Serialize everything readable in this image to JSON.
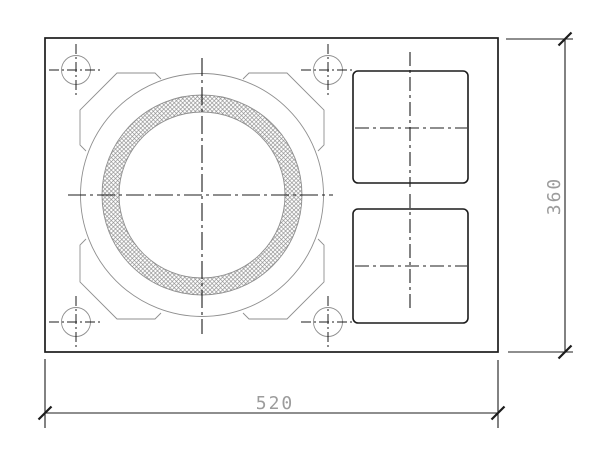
{
  "drawing": {
    "background": "#ffffff",
    "colors": {
      "primary_line": "#1c1c1c",
      "thin_line": "#8f8f8f",
      "hatch_line": "#8a8a8a",
      "dim_text": "#9c9c9c"
    },
    "plate": {
      "x": 45,
      "y": 38,
      "width": 453,
      "height": 314
    },
    "boss": {
      "cx": 202,
      "cy": 195,
      "outer_radius": 121.5,
      "ring": {
        "outer_radius": 100,
        "inner_radius": 83
      },
      "brackets": [
        [
          [
            86,
            151
          ],
          [
            80,
            145
          ],
          [
            80,
            110
          ],
          [
            117,
            73
          ],
          [
            155,
            73
          ],
          [
            161,
            79
          ]
        ],
        [
          [
            243,
            79
          ],
          [
            249,
            73
          ],
          [
            287,
            73
          ],
          [
            324,
            110
          ],
          [
            324,
            145
          ],
          [
            318,
            151
          ]
        ],
        [
          [
            318,
            239
          ],
          [
            324,
            245
          ],
          [
            324,
            282
          ],
          [
            287,
            319
          ],
          [
            249,
            319
          ],
          [
            243,
            313
          ]
        ],
        [
          [
            161,
            313
          ],
          [
            155,
            319
          ],
          [
            117,
            319
          ],
          [
            80,
            282
          ],
          [
            80,
            245
          ],
          [
            86,
            239
          ]
        ]
      ],
      "centerline_h": [
        68,
        195,
        333,
        195
      ],
      "centerline_v": [
        202,
        58,
        202,
        334
      ]
    },
    "bolt_holes": {
      "radius": 14.5,
      "cross_half_h": 27,
      "cross_half_v": 26,
      "centers": [
        [
          76,
          70
        ],
        [
          328,
          70
        ],
        [
          76,
          322
        ],
        [
          328,
          322
        ]
      ]
    },
    "pockets": [
      {
        "x": 353,
        "y": 71,
        "width": 115,
        "height": 112,
        "corner_radius": 5,
        "centerline_h": [
          355,
          128,
          467,
          128
        ],
        "centerline_v": [
          410,
          52,
          410,
          187
        ]
      },
      {
        "x": 353,
        "y": 209,
        "width": 115,
        "height": 114,
        "corner_radius": 5,
        "centerline_h": [
          355,
          266,
          467,
          266
        ],
        "centerline_v": [
          410,
          194,
          410,
          311
        ]
      }
    ],
    "dimensions": {
      "bottom": {
        "label": "520",
        "line": [
          45,
          413,
          498,
          413
        ],
        "extensions": [
          [
            45,
            359,
            45,
            428
          ],
          [
            498,
            360,
            498,
            428
          ]
        ],
        "ticks": [
          [
            45,
            413
          ],
          [
            498,
            413
          ]
        ],
        "text_pos": [
          275,
          409
        ],
        "rotation": 0
      },
      "right": {
        "label": "360",
        "line": [
          565,
          39,
          565,
          352
        ],
        "extensions": [
          [
            506,
            39,
            573,
            39
          ],
          [
            508,
            352,
            573,
            352
          ]
        ],
        "ticks": [
          [
            565,
            39
          ],
          [
            565,
            352
          ]
        ],
        "text_pos": [
          560,
          196
        ],
        "rotation": -90
      }
    }
  }
}
